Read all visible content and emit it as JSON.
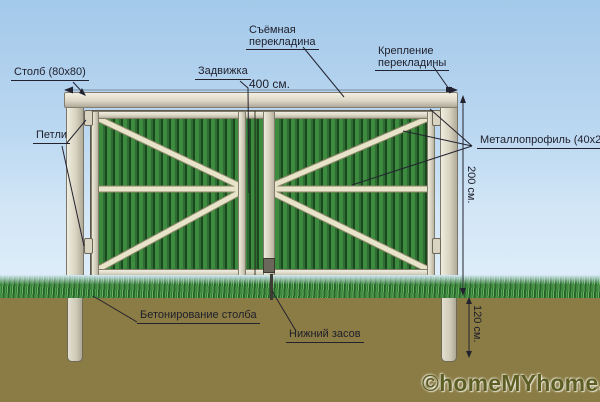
{
  "diagram": {
    "title_context": "Gate construction scheme",
    "labels": {
      "post": "Столб (80x80)",
      "hinges": "Петли",
      "latch": "Задвижка",
      "removable_crossbar": [
        "Съёмная",
        "перекладина"
      ],
      "crossbar_mount": [
        "Крепление",
        "перекладины"
      ],
      "metal_profile": "Металлопрофиль (40x20)",
      "post_concreting": "Бетонирование столба",
      "bottom_bolt": "Нижний засов"
    },
    "dimensions": {
      "gate_width": "400 см.",
      "gate_height": "200 см.",
      "post_depth": "120 см."
    },
    "watermark": "©homeMYhome.ru",
    "colors": {
      "sky_top": "#a3c9ea",
      "sky_bottom": "#e2eff9",
      "profile_green": "#3c8b3e",
      "profile_green_dark": "#1c481f",
      "frame_beige": "#d8d3c1",
      "soil": "#8b7c45",
      "label_ink": "#1e1e2a",
      "watermark_color": "#5c5e24"
    }
  }
}
